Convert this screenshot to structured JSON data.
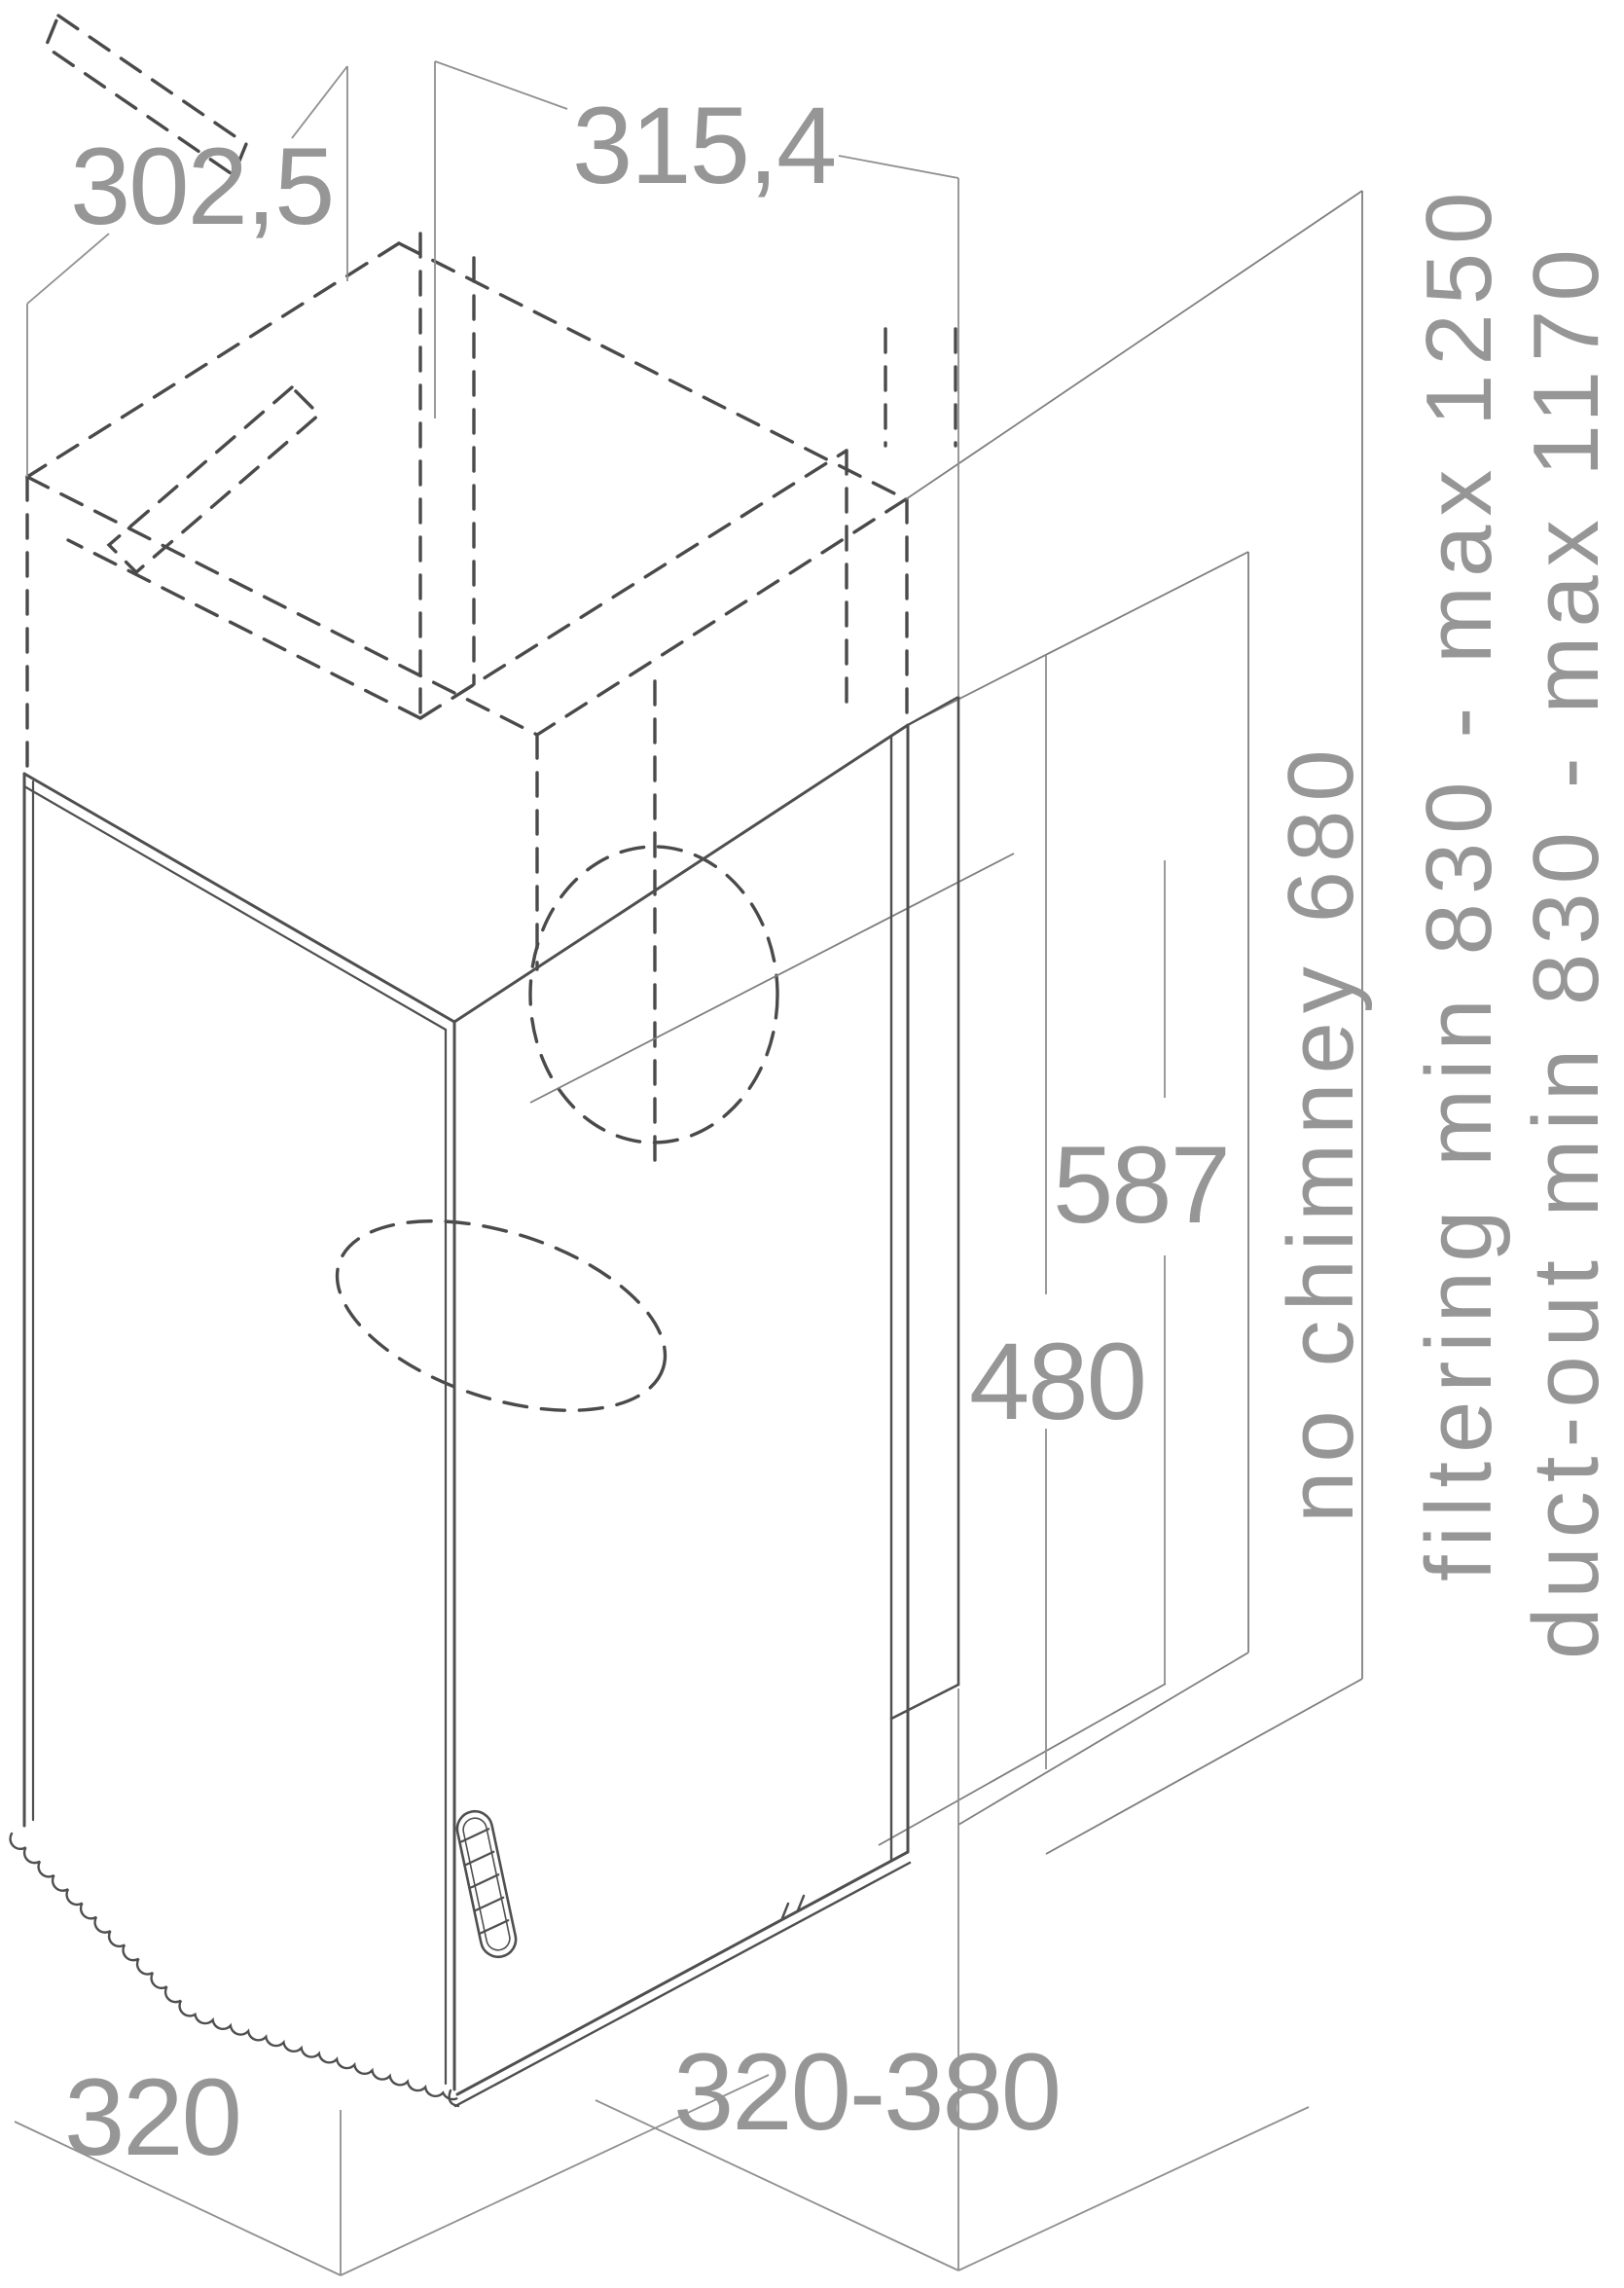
{
  "diagram": {
    "type": "installation-dimension-drawing",
    "subject": "cooker hood with telescopic chimney, isometric view",
    "units": "mm"
  },
  "labels": {
    "top_depth": "302,5",
    "top_width": "315,4",
    "no_chimney": "no chimney 680",
    "filtering_range": "filtering min 830 - max 1250",
    "duct_out_range": "duct-out min 830 - max 1170",
    "right_height_upper": "587",
    "right_height_lower": "480",
    "bottom_left_depth": "320",
    "bottom_front_width": "320-380"
  },
  "colors": {
    "background": "#ffffff",
    "dashed_outline": "#4a4a4a",
    "solid_body": "#4f4f4f",
    "panel_lines": "#7f7f7f",
    "dimension_lines": "#8f8f8f",
    "dimension_text": "#969696"
  }
}
